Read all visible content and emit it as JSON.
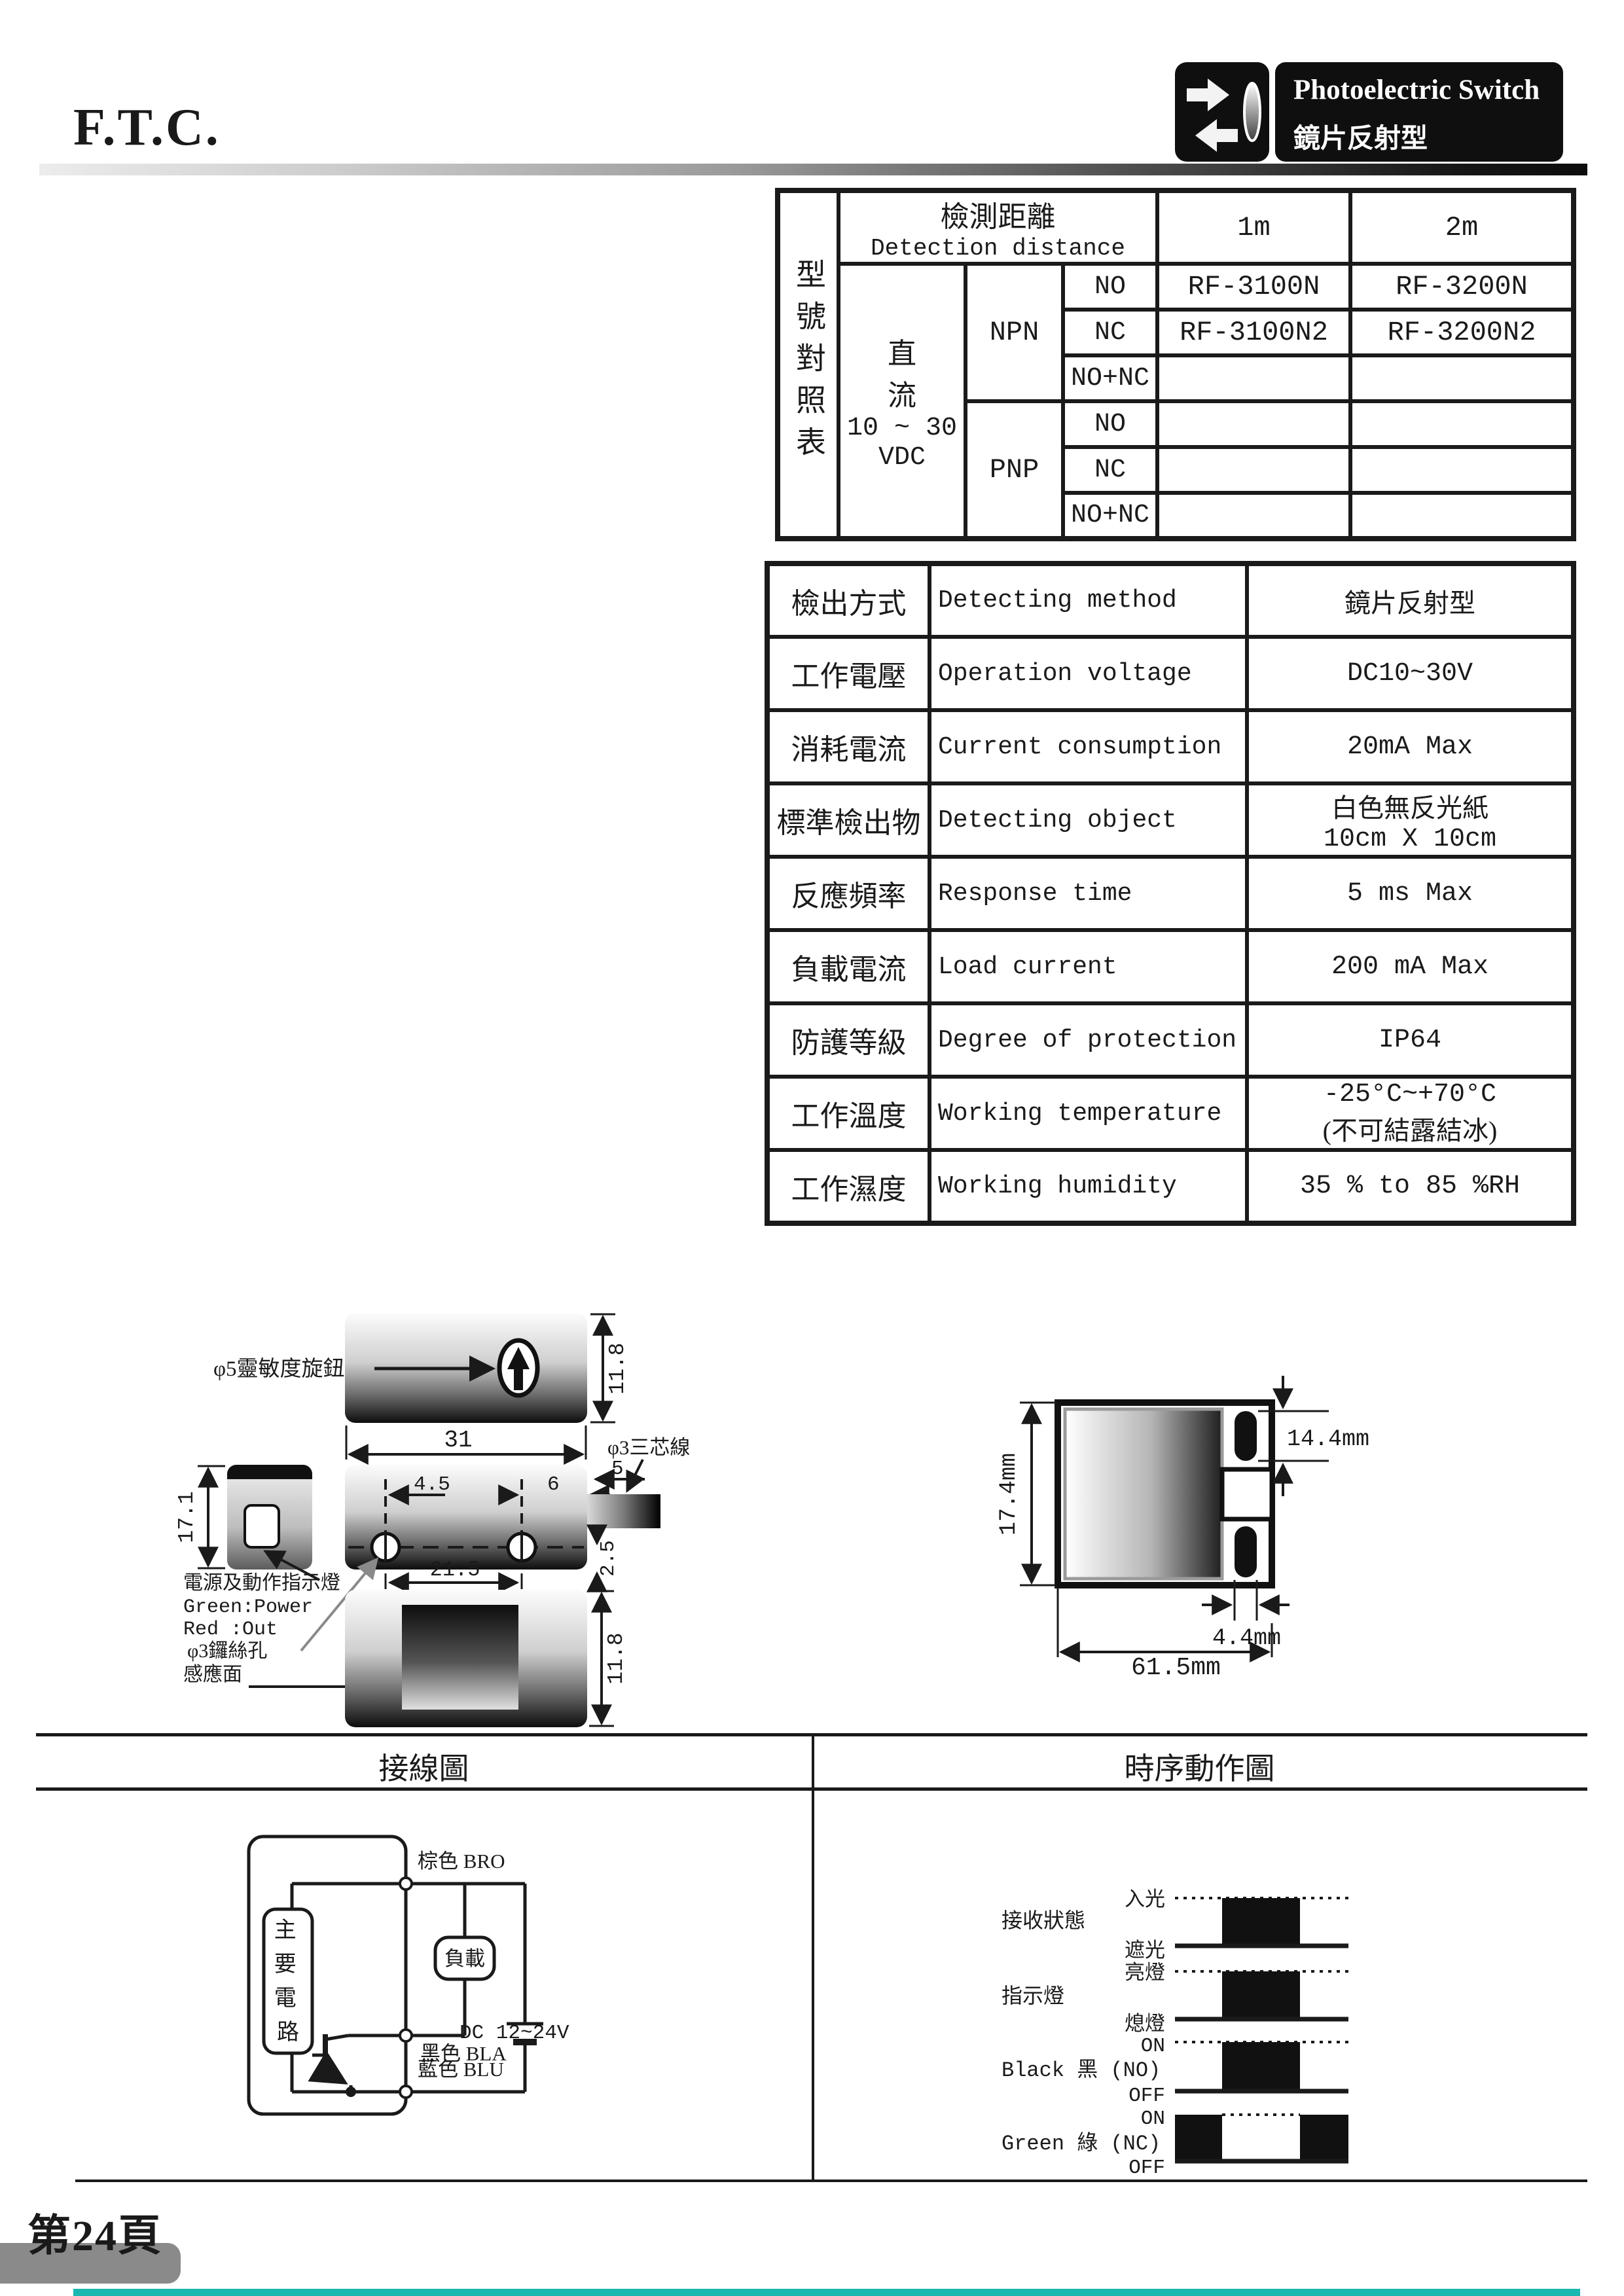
{
  "page": {
    "company": "F.T.C.",
    "page_number": "第24頁"
  },
  "badge": {
    "title": "Photoelectric Switch",
    "subtitle": "鏡片反射型"
  },
  "model_table": {
    "side_label": "型號對照表",
    "detection_cn": "檢測距離",
    "detection_en": "Detection distance",
    "col_1m": "1m",
    "col_2m": "2m",
    "power_lines": [
      "直",
      "流",
      "10 ~ 30",
      "VDC"
    ],
    "npn": "NPN",
    "pnp": "PNP",
    "rows": [
      {
        "out": "NO",
        "m1": "RF-3100N",
        "m2": "RF-3200N"
      },
      {
        "out": "NC",
        "m1": "RF-3100N2",
        "m2": "RF-3200N2"
      },
      {
        "out": "NO+NC",
        "m1": "",
        "m2": ""
      },
      {
        "out": "NO",
        "m1": "",
        "m2": ""
      },
      {
        "out": "NC",
        "m1": "",
        "m2": ""
      },
      {
        "out": "NO+NC",
        "m1": "",
        "m2": ""
      }
    ]
  },
  "spec_table": {
    "rows": [
      {
        "cn": "檢出方式",
        "en": "Detecting method",
        "value": "鏡片反射型",
        "value2": ""
      },
      {
        "cn": "工作電壓",
        "en": "Operation voltage",
        "value": "DC10~30V",
        "value2": ""
      },
      {
        "cn": "消耗電流",
        "en": "Current consumption",
        "value": "20mA  Max",
        "value2": ""
      },
      {
        "cn": "標準檢出物",
        "en": "Detecting object",
        "value": "白色無反光紙",
        "value2": "10cm X 10cm"
      },
      {
        "cn": "反應頻率",
        "en": "Response time",
        "value": "5 ms Max",
        "value2": ""
      },
      {
        "cn": "負載電流",
        "en": "Load current",
        "value": "200 mA  Max",
        "value2": ""
      },
      {
        "cn": "防護等級",
        "en": "Degree of protection",
        "value": "IP64",
        "value2": ""
      },
      {
        "cn": "工作溫度",
        "en": "Working temperature",
        "value": "-25°C~+70°C",
        "value2": "(不可結露結冰)"
      },
      {
        "cn": "工作濕度",
        "en": "Working humidity",
        "value": "35 % to 85 %RH",
        "value2": ""
      }
    ]
  },
  "dimension_left": {
    "knob_label": "φ5靈敏度旋鈕",
    "wire_label": "φ3三芯線",
    "indicator_label": "電源及動作指示燈",
    "indicator_green": "Green:Power",
    "indicator_red": "Red  :Out",
    "screw_label": "φ3鑼絲孔",
    "face_label": "感應面",
    "dim_top_height": "11.8",
    "dim_width": "31",
    "dim_45": "4.5",
    "dim_6": "6",
    "dim_5": "5",
    "dim_25": "2.5",
    "dim_side_height": "17.1",
    "dim_hole_pitch": "21.5",
    "dim_bottom_height": "11.8"
  },
  "dimension_right": {
    "dim_height": "17.4mm",
    "dim_hole": "14.4mm",
    "dim_hole_offset": "4.4mm",
    "dim_width": "61.5mm"
  },
  "sections": {
    "wiring_title": "接線圖",
    "timing_title": "時序動作圖"
  },
  "wiring": {
    "main_circuit_chars": [
      "主",
      "要",
      "電",
      "路"
    ],
    "load": "負載",
    "brown": "棕色 BRO",
    "black": "黑色 BLA",
    "blue": "藍色 BLU",
    "supply": "DC 12~24V"
  },
  "timing": {
    "rows": [
      {
        "label": "接收狀態",
        "high": "入光",
        "low": "遮光"
      },
      {
        "label": "指示燈",
        "high": "亮燈",
        "low": "熄燈"
      },
      {
        "label": "Black 黑 (NO)",
        "high": "ON",
        "low": "OFF"
      },
      {
        "label": "Green 綠 (NC)",
        "high": "ON",
        "low": "OFF"
      }
    ]
  },
  "colors": {
    "ink": "#1a1a1a",
    "tab_gray": "#8a8a8a",
    "accent_teal": "#1ab8b0"
  }
}
